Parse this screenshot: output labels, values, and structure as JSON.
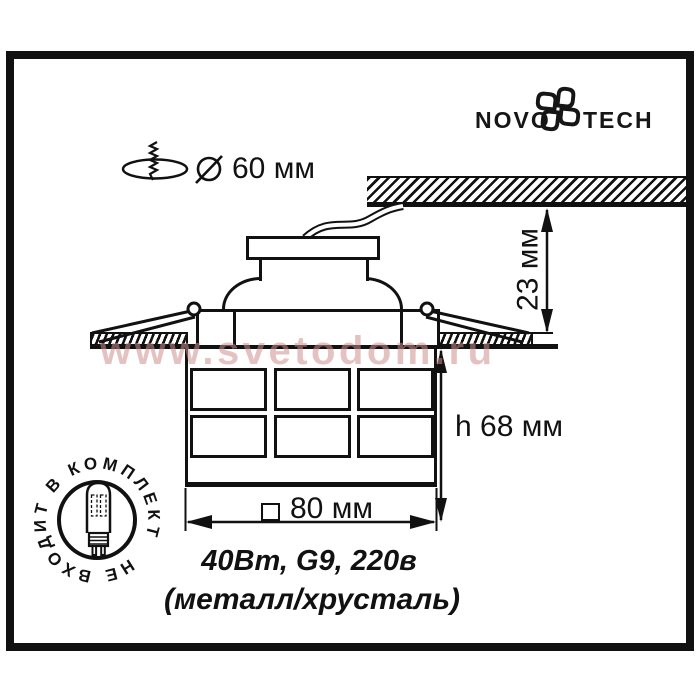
{
  "brand": {
    "left": "NOVO",
    "right": "TECH"
  },
  "dimensions": {
    "cutout": "60 мм",
    "depth": "23 мм",
    "height": "h 68 мм",
    "width": "80 мм"
  },
  "specs": {
    "line1": "40Вт, G9, 220в",
    "line2": "(металл/хрусталь)"
  },
  "stamp": {
    "text": "НЕ ВХОДИТ В КОМПЛЕКТ"
  },
  "watermark": {
    "text": "www.svetodom.ru"
  },
  "colors": {
    "line": "#111111",
    "watermark": "rgba(206,144,144,0.55)"
  }
}
